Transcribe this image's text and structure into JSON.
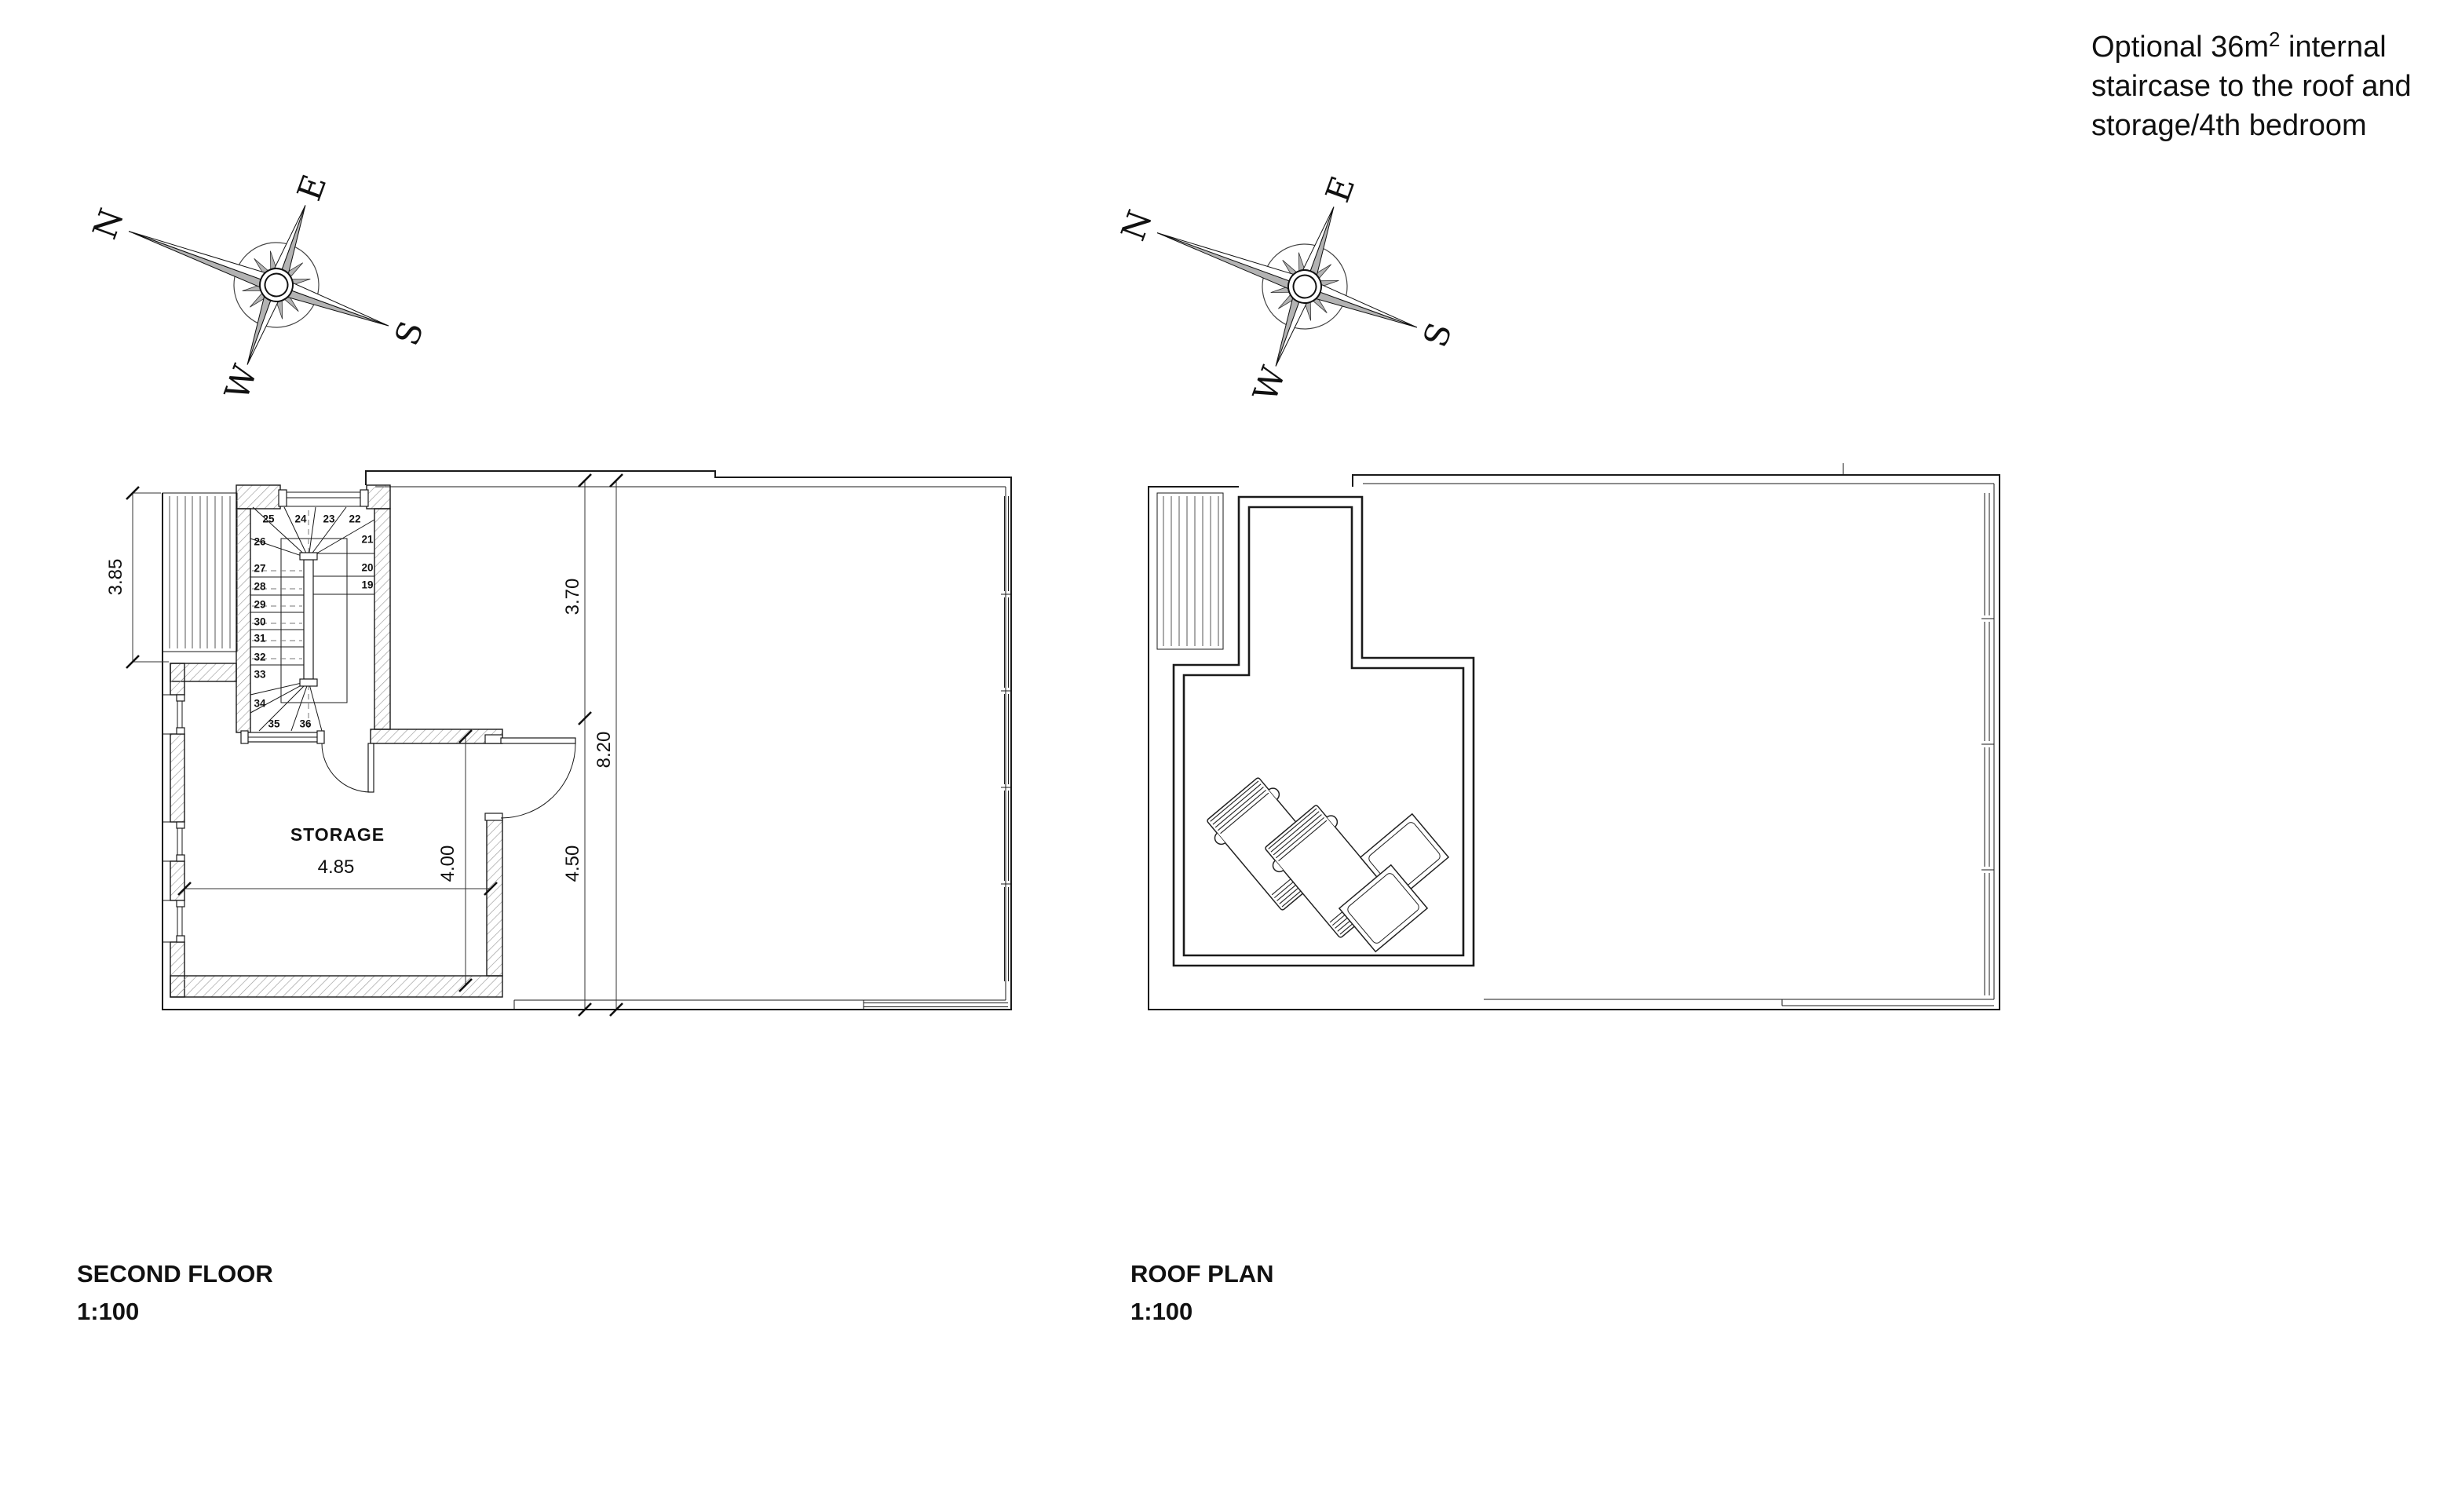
{
  "note": {
    "line1_pre": "Optional 36m",
    "line1_sup": "2",
    "line1_post": " internal",
    "line2": "staircase to the roof and",
    "line3": "storage/4th bedroom"
  },
  "compass": {
    "n": "N",
    "e": "E",
    "s": "S",
    "w": "W"
  },
  "second_floor": {
    "title": "SECOND FLOOR",
    "scale": "1:100",
    "room_label": "STORAGE",
    "dims": {
      "deck_height": "3.85",
      "storage_width": "4.85",
      "storage_height": "4.00",
      "right_upper": "3.70",
      "right_lower": "4.50",
      "right_total": "8.20"
    },
    "stair_steps": [
      "19",
      "20",
      "21",
      "22",
      "23",
      "24",
      "25",
      "26",
      "27",
      "28",
      "29",
      "30",
      "31",
      "32",
      "33",
      "34",
      "35",
      "36"
    ]
  },
  "roof": {
    "title": "ROOF PLAN",
    "scale": "1:100"
  },
  "colors": {
    "line": "#1a1a1a",
    "hatch": "#9a9a9a",
    "compass_gray": "#b3b3b3",
    "background": "#ffffff"
  }
}
